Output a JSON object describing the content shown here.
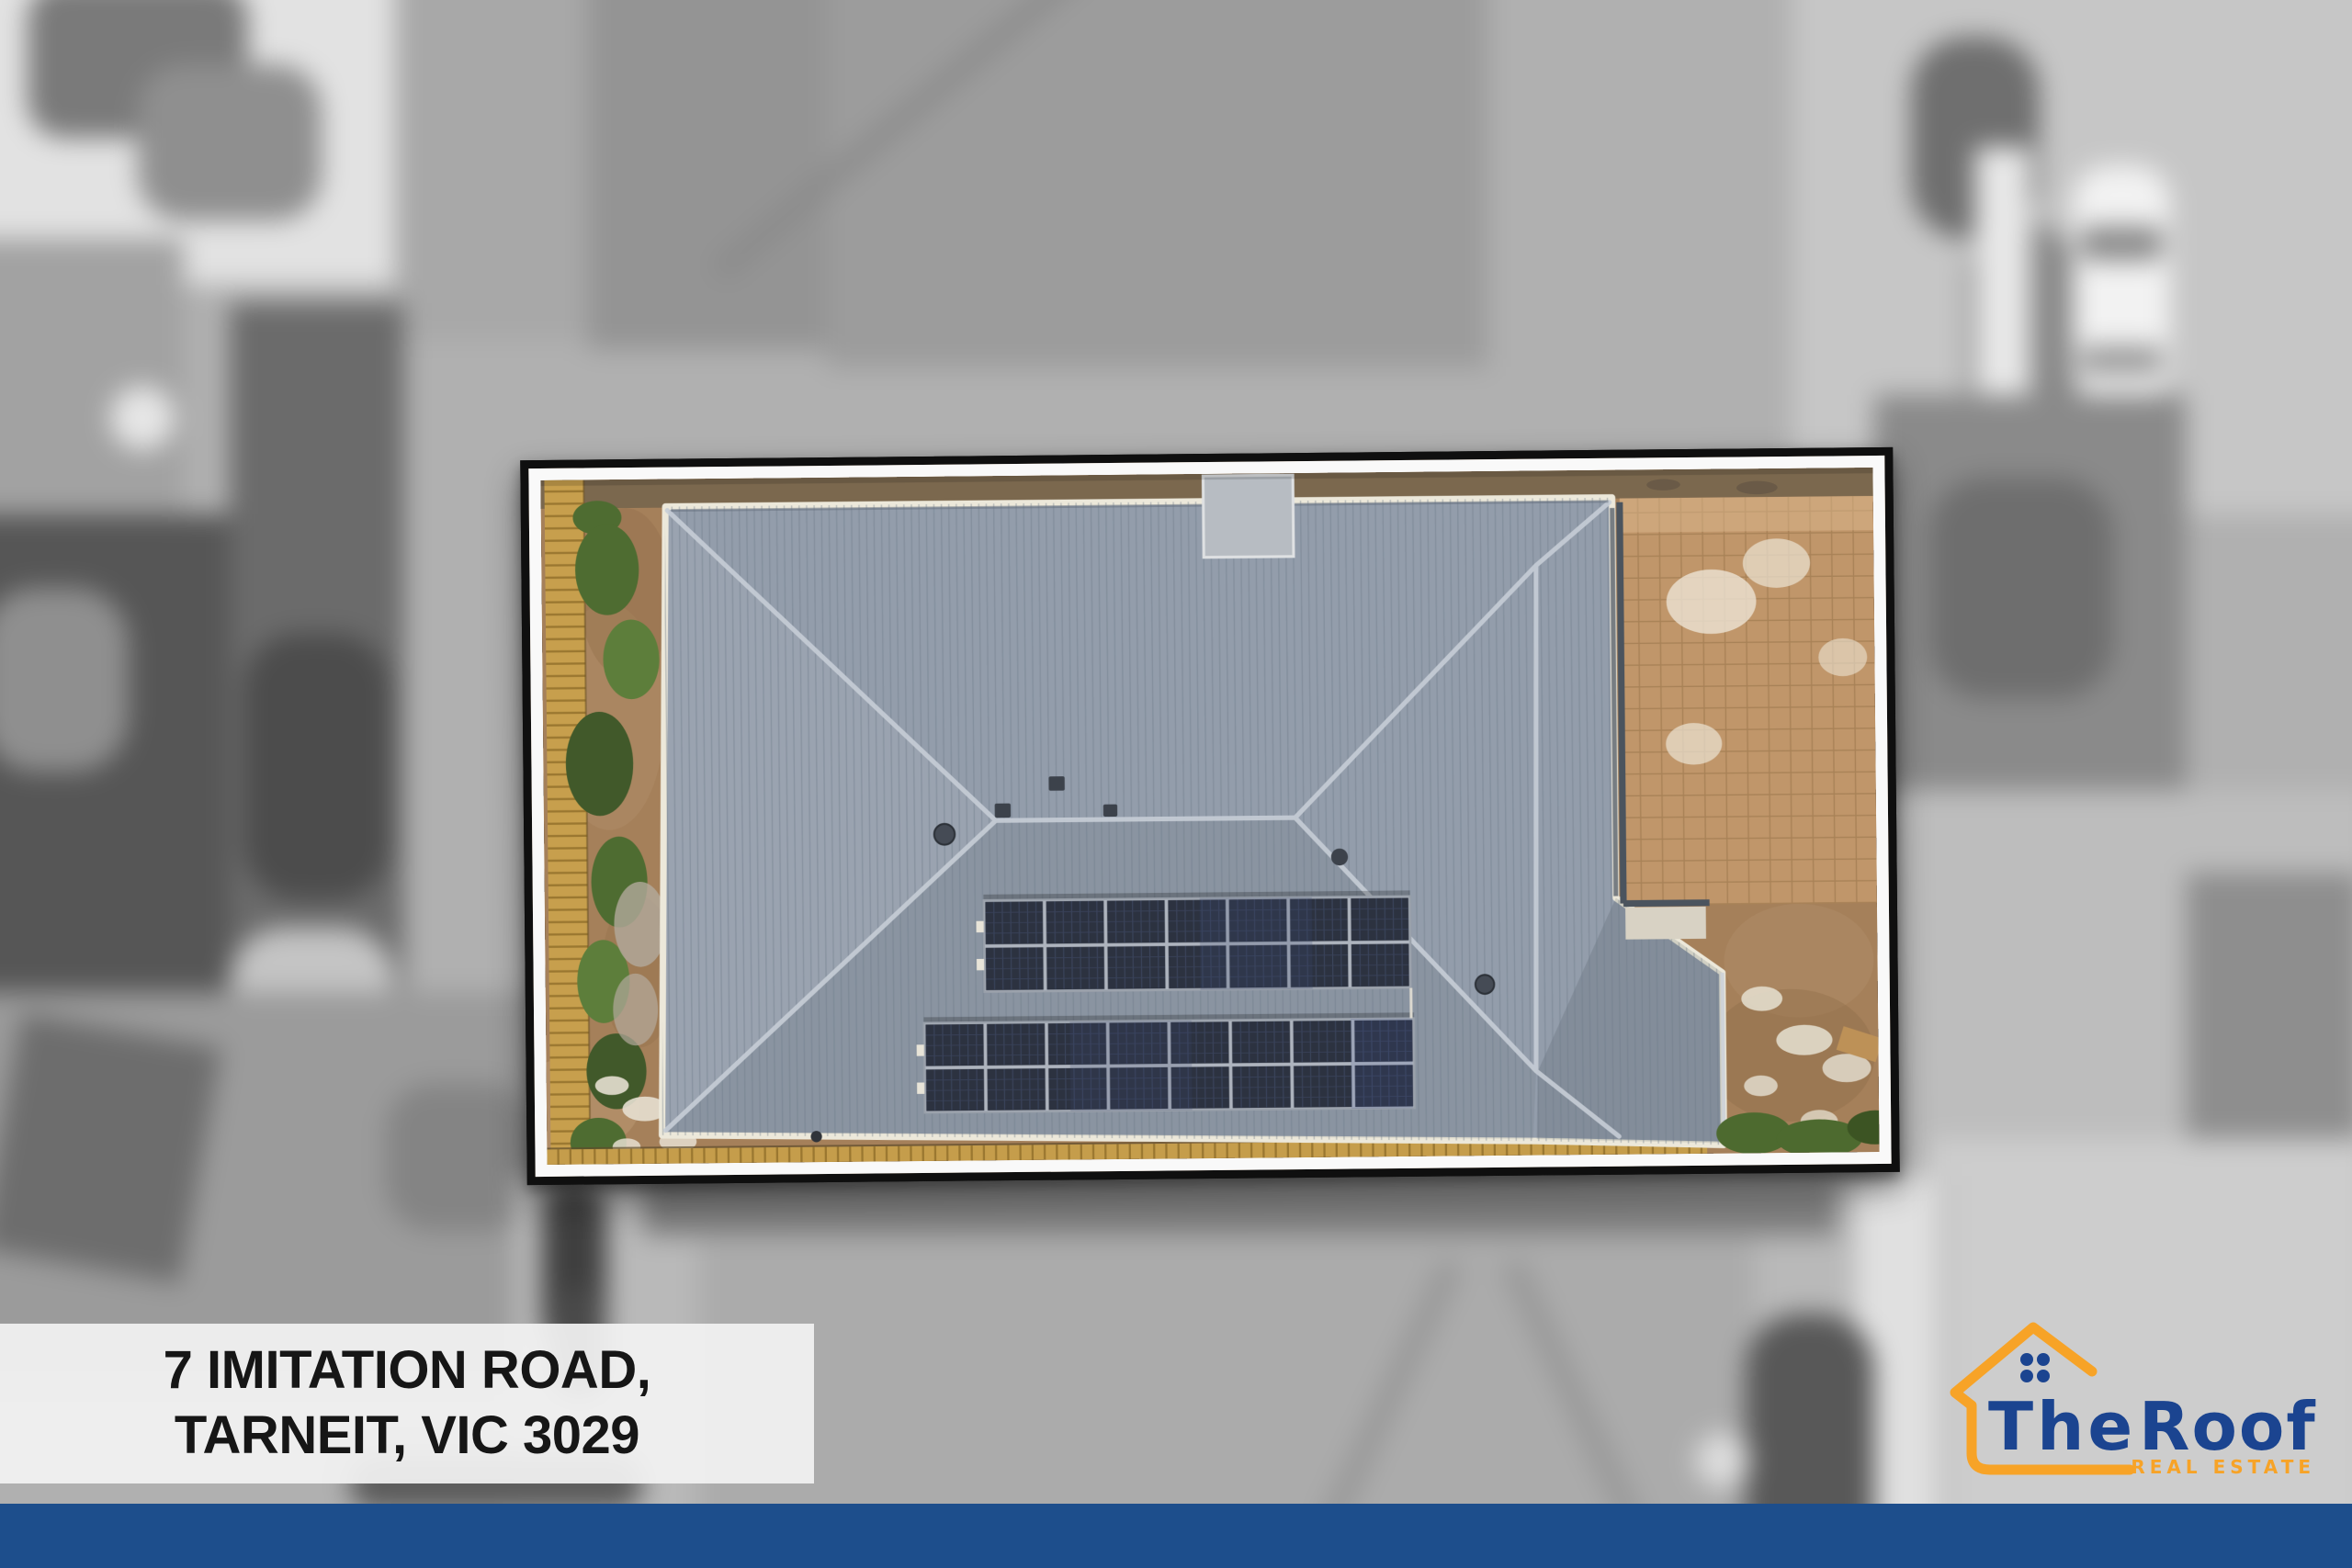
{
  "address_plate": {
    "line1": "7 IMITATION ROAD,",
    "line2": "TARNEIT, VIC 3029"
  },
  "brand": {
    "word1": "The",
    "word2": "Roof",
    "tagline": "REAL ESTATE",
    "colors": {
      "navy": "#1b4490",
      "orange": "#f7a327",
      "footer_bar": "#1d4e8c"
    }
  },
  "photo": {
    "style": "colour aerial drone view of the subject property inside a black and white frame; surrounding neighbourhood blurred greyscale",
    "roof_colour": "blue-grey corrugated",
    "solar_arrays": [
      {
        "location": "upper",
        "panels_across": 7,
        "panels_down": 2
      },
      {
        "location": "lower",
        "panels_across": 8,
        "panels_down": 2
      }
    ],
    "other_features": [
      "timber fence on left boundary",
      "green shrubs along fence",
      "paved courtyard top right",
      "bare earth yard",
      "roof vents"
    ]
  }
}
